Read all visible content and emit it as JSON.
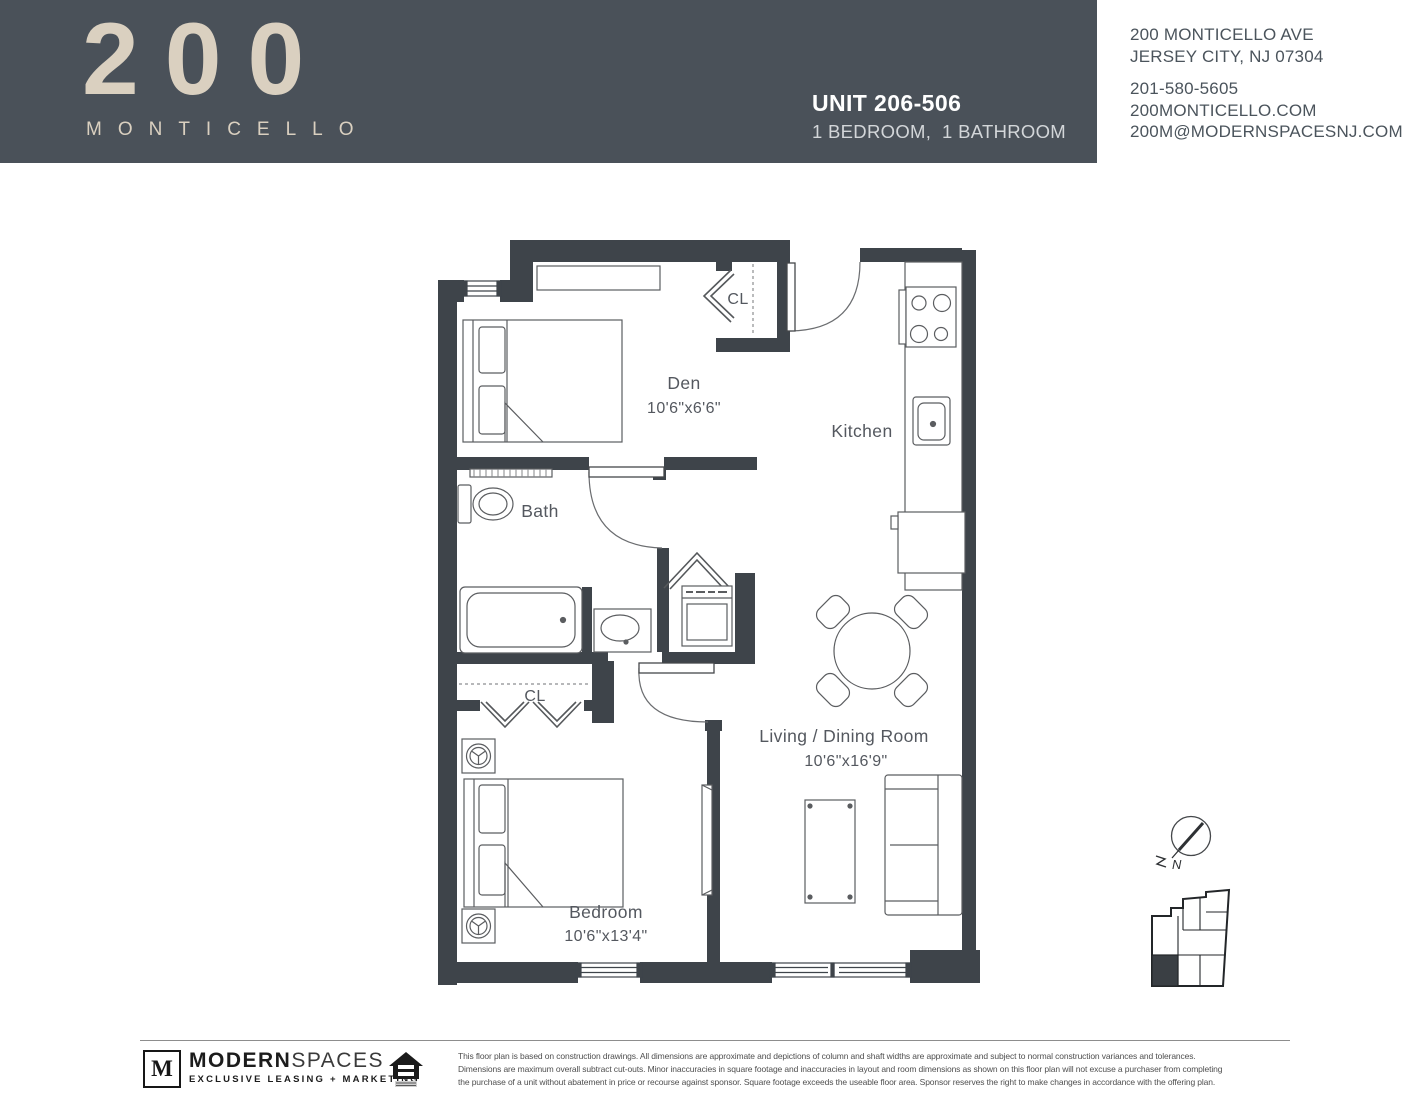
{
  "header": {
    "logo_number": "200",
    "logo_name": "MONTICELLO",
    "unit_title": "UNIT 206-506",
    "unit_subtitle": "1 BEDROOM,  1 BATHROOM",
    "bg_color": "#4a5159",
    "logo_color": "#dad0c0"
  },
  "contact": {
    "address_line1": "200 MONTICELLO AVE",
    "address_line2": "JERSEY CITY, NJ 07304",
    "phone": "201-580-5605",
    "website": "200MONTICELLO.COM",
    "email": "200M@MODERNSPACESNJ.COM"
  },
  "floorplan": {
    "wall_color": "#3e444a",
    "rooms": {
      "den": {
        "name": "Den",
        "dims": "10'6\"x6'6\""
      },
      "kitchen": {
        "name": "Kitchen"
      },
      "bath": {
        "name": "Bath"
      },
      "closet_entry": {
        "name": "CL"
      },
      "closet_bedroom": {
        "name": "CL"
      },
      "living": {
        "name": "Living / Dining Room",
        "dims": "10'6\"x16'9\""
      },
      "bedroom": {
        "name": "Bedroom",
        "dims": "10'6\"x13'4\""
      }
    },
    "compass_label": "N"
  },
  "footer": {
    "brand_initial": "M",
    "brand_name_bold": "MODERN",
    "brand_name_light": "SPACES",
    "brand_tagline": "EXCLUSIVE LEASING + MARKETING",
    "disclaimer_line1": "This floor plan is based on construction drawings. All dimensions are approximate and depictions of column and shaft widths are approximate and subject to normal construction variances and tolerances.",
    "disclaimer_line2": "Dimensions are maximum overall subtract cut-outs. Minor inaccuracies in square footage and inaccuracies in layout and room dimensions as shown on this floor plan will not excuse a purchaser from completing",
    "disclaimer_line3": "the purchase of a unit without abatement in price or recourse against sponsor. Square footage exceeds the useable floor area. Sponsor reserves the right to make changes in accordance with the offering plan."
  }
}
